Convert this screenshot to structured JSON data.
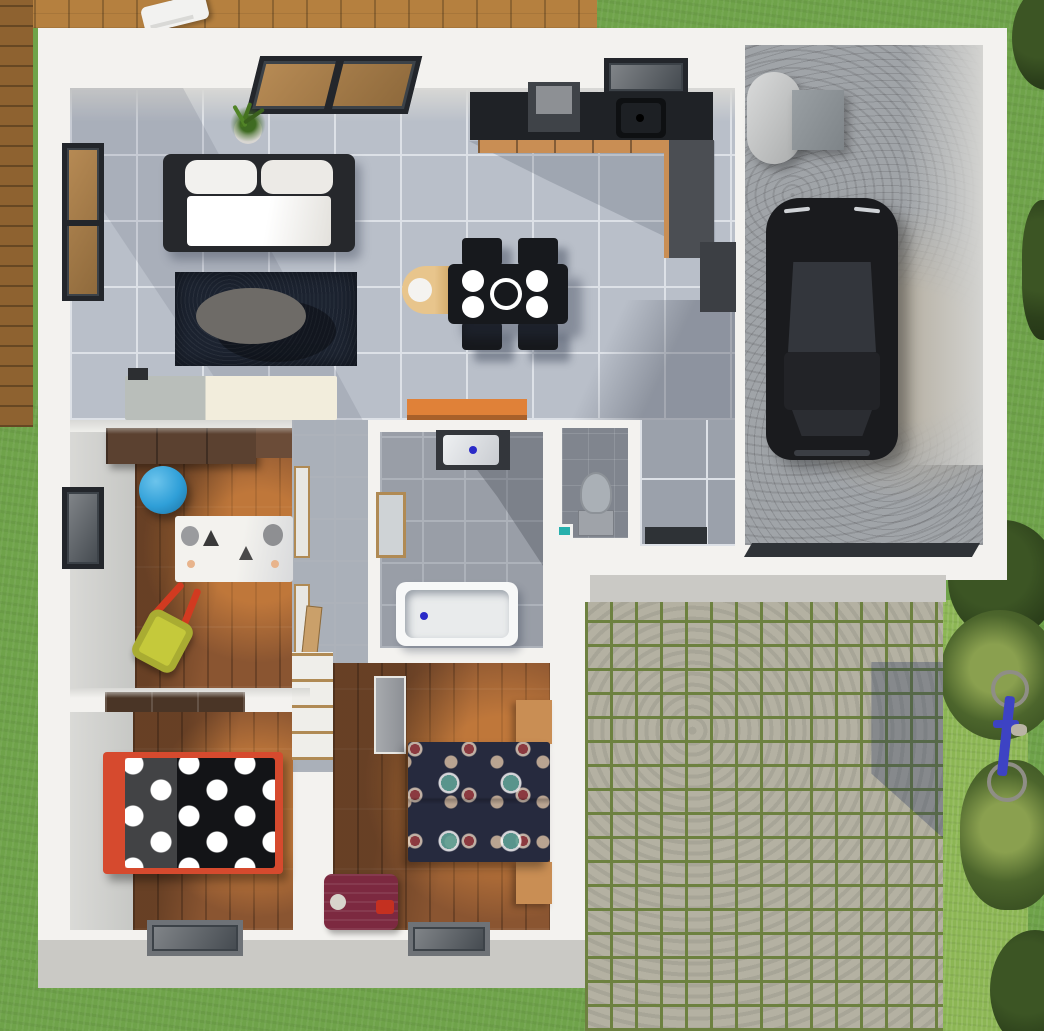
{
  "meta": {
    "type": "3d-floor-plan-render",
    "view": "top-down",
    "contains_text": false
  },
  "palette": {
    "wall": "#f3f2ef",
    "wallShade": "#d8d8d5",
    "grass": "#6fa34a",
    "grassBright": "#8cb654",
    "grassDark": "#57803b",
    "deck": "#b5803f",
    "deckDark": "#8e6230",
    "tile": "#b9bfc9",
    "tileLine": "#dde1e7",
    "bathTile": "#999ea7",
    "bathLine": "#adb2ba",
    "toiletTile": "#80858e",
    "wood": "#8a5531",
    "woodSun": "#c98a45",
    "navyRug": "#1c2330",
    "sofaFrame": "#26282c",
    "counter": "#1f2226",
    "cab": "#c98e54",
    "cabDark": "#4b4e53",
    "orange": "#e08138",
    "concrete": "#a0a4a8",
    "concreteLight": "#b5afa2",
    "car": "#1a1b1e",
    "carGlass": "#33363c",
    "cobbleStone": "#b4b1a2",
    "cobbleJoint": "#6d8140",
    "apron": "#cac9c5",
    "bedRed": "#d64a2e",
    "duvetBlack": "#131417",
    "duvet2": "#262a3e",
    "doorDark": "#2f3337",
    "suitcase": "#7c2940",
    "ballBlue": "#2f9fd8",
    "cartYellow": "#c5c93b",
    "bike": "#3d43c4",
    "matDark": "#2e3236",
    "vanity": "#33363b",
    "tub": "#e9ebec",
    "heater": "#c7c9c9",
    "boiler": "#8e9296"
  },
  "scene": {
    "exterior": {
      "areas": [
        "lawn",
        "wood-deck",
        "cobblestone-driveway",
        "driveway-apron",
        "shrubs"
      ],
      "objects": [
        "deck-chair",
        "bicycle"
      ]
    },
    "rooms": [
      {
        "name": "living-room",
        "floor": "light-gray-tile",
        "objects": [
          "sofa",
          "area-rug",
          "coffee-table",
          "potted-plant",
          "patio-window",
          "side-window",
          "low-sideboard"
        ]
      },
      {
        "name": "kitchen-dining",
        "floor": "light-gray-tile",
        "objects": [
          "countertop",
          "sink",
          "sink-window",
          "cooker-hood",
          "cabinets",
          "tall-cabinet",
          "appliance",
          "dining-table",
          "plates",
          "serving-bowl",
          "dining-chairs",
          "high-chair",
          "orange-sideboard"
        ]
      },
      {
        "name": "bathroom",
        "floor": "gray-tile",
        "objects": [
          "vanity-sink",
          "mirror",
          "bathtub"
        ]
      },
      {
        "name": "wc",
        "floor": "dark-gray-tile",
        "objects": [
          "toilet",
          "corner-sink"
        ]
      },
      {
        "name": "entry-hall",
        "floor": "gray-tile",
        "objects": [
          "door-mat"
        ]
      },
      {
        "name": "hallway",
        "floor": "gray-tile",
        "objects": [
          "open-doors"
        ]
      },
      {
        "name": "kids-room",
        "floor": "wood",
        "objects": [
          "wardrobe",
          "exercise-ball",
          "play-mat",
          "toy-wheelbarrow",
          "side-window"
        ]
      },
      {
        "name": "bedroom-1",
        "floor": "wood",
        "objects": [
          "wardrobe",
          "bed-red-frame-polka-duvet",
          "facade-window"
        ]
      },
      {
        "name": "bedroom-2",
        "floor": "wood",
        "objects": [
          "closet",
          "double-bed-dotted-duvet",
          "nightstand-top",
          "nightstand-bottom",
          "suitcase",
          "facade-window"
        ]
      },
      {
        "name": "garage",
        "floor": "concrete",
        "objects": [
          "water-heater",
          "boiler-unit",
          "car",
          "garage-door"
        ]
      }
    ]
  }
}
